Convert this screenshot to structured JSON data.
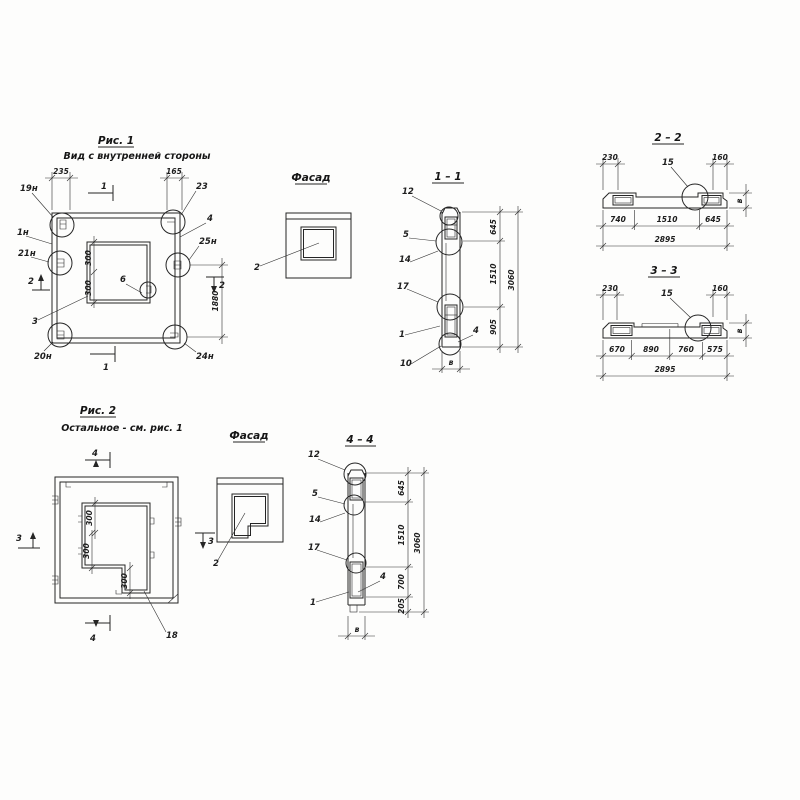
{
  "figure1": {
    "title": "Рис. 1",
    "subtitle": "Вид с внутренней стороны",
    "dim_top_left": "235",
    "dim_top_right": "165",
    "dim_right": "1880",
    "dim_inner_1": "300",
    "dim_inner_2": "300",
    "callout_19n": "19н",
    "callout_1n": "1н",
    "callout_21n": "21н",
    "callout_20n": "20н",
    "callout_23": "23",
    "callout_4": "4",
    "callout_25n": "25н",
    "callout_24n": "24н",
    "callout_3": "3",
    "callout_6": "6",
    "section_1": "1",
    "section_2": "2"
  },
  "facade1": {
    "title": "Фасад",
    "callout_2": "2"
  },
  "section11": {
    "title": "1 – 1",
    "callout_12": "12",
    "callout_5": "5",
    "callout_14": "14",
    "callout_17": "17",
    "callout_1": "1",
    "callout_10": "10",
    "callout_4": "4",
    "dim_645": "645",
    "dim_1510": "1510",
    "dim_905": "905",
    "dim_total": "3060",
    "dim_width": "в"
  },
  "section22": {
    "title": "2 – 2",
    "callout_15": "15",
    "dim_230": "230",
    "dim_160": "160",
    "dim_740": "740",
    "dim_1510": "1510",
    "dim_645": "645",
    "dim_total": "2895",
    "dim_thickness": "в"
  },
  "section33": {
    "title": "3 – 3",
    "callout_15": "15",
    "dim_230": "230",
    "dim_160": "160",
    "dim_670": "670",
    "dim_890": "890",
    "dim_760": "760",
    "dim_575": "575",
    "dim_total": "2895",
    "dim_thickness": "в"
  },
  "figure2": {
    "title": "Рис. 2",
    "subtitle": "Остальное - см. рис. 1",
    "dim_300a": "300",
    "dim_300b": "300",
    "dim_300c": "300",
    "callout_18": "18",
    "section_3": "3",
    "section_4": "4"
  },
  "facade2": {
    "title": "Фасад",
    "callout_2": "2"
  },
  "section44": {
    "title": "4 – 4",
    "callout_12": "12",
    "callout_5": "5",
    "callout_14": "14",
    "callout_17": "17",
    "callout_4": "4",
    "callout_1": "1",
    "dim_645": "645",
    "dim_1510": "1510",
    "dim_700": "700",
    "dim_205": "205",
    "dim_total": "3060",
    "dim_width": "в"
  }
}
